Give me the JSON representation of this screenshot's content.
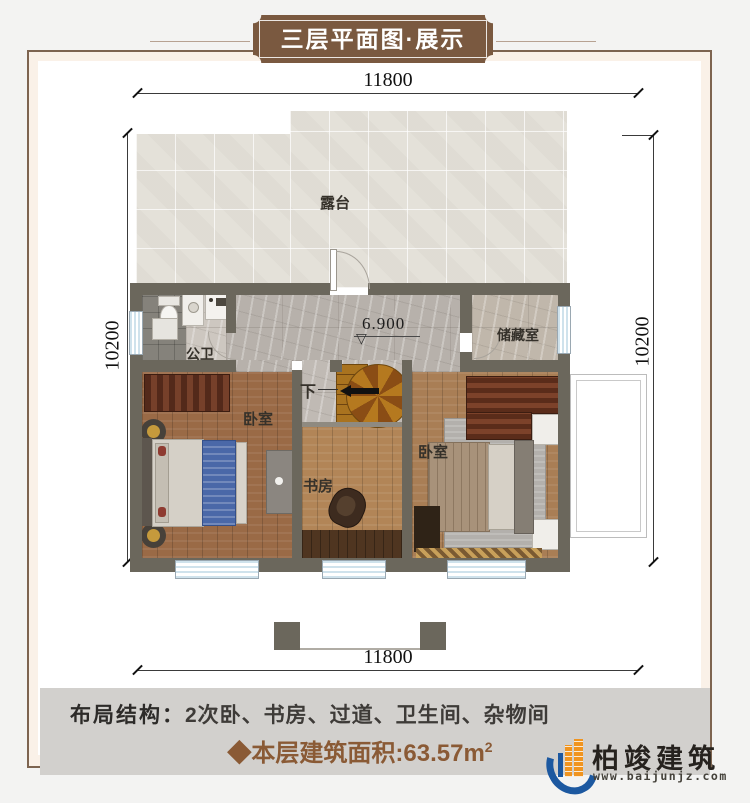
{
  "banner": {
    "title": "三层平面图·展示"
  },
  "dimensions": {
    "top": "11800",
    "bottom": "11800",
    "left": "10200",
    "right": "10200"
  },
  "plan": {
    "terrace_label": "露台",
    "bathroom_label": "公卫",
    "storage_label": "储藏室",
    "bedroom_left_label": "卧室",
    "bedroom_right_label": "卧室",
    "study_label": "书房",
    "stairs_down_label": "下",
    "elevation_value": "6.900",
    "elevation_symbol": "▽"
  },
  "footer": {
    "layout_label": "布局结构：",
    "layout_value": "2次卧、书房、过道、卫生间、杂物间",
    "area_prefix": "◆",
    "area_text": "本层建筑面积:63.57m",
    "area_sup": "2"
  },
  "logo": {
    "company": "柏竣建筑",
    "website": "www.baijunjz.com"
  },
  "colors": {
    "wall": "#6b675c",
    "banner_brown": "#7a5940",
    "area_text_brown": "#8a5a35",
    "logo_blue": "#1c58a0",
    "logo_orange": "#f0941f",
    "footer_band": "#d2d0cd"
  }
}
